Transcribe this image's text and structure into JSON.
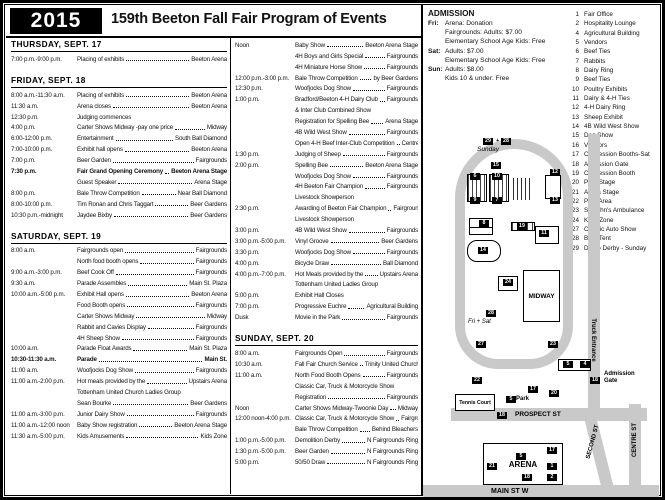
{
  "header": {
    "year": "2015",
    "title": "159th Beeton Fall Fair Program of Events"
  },
  "admission": {
    "title": "ADMISSION",
    "rows": [
      {
        "day": "Fri:",
        "text": "Arena: Donation"
      },
      {
        "day": "",
        "text": "Fairgrounds: Adults: $7.00"
      },
      {
        "day": "",
        "text": "Elementary School Age Kids: Free"
      },
      {
        "day": "Sat:",
        "text": "Adults: $7.00"
      },
      {
        "day": "",
        "text": "Elementary School Age Kids: Free"
      },
      {
        "day": "Sun:",
        "text": "Adults: $8.00"
      },
      {
        "day": "",
        "text": "Kids 10 & under: Free"
      }
    ]
  },
  "legend": {
    "items": [
      {
        "num": "1",
        "label": "Fair Office"
      },
      {
        "num": "2",
        "label": "Hospitality Lounge"
      },
      {
        "num": "4",
        "label": "Agricultural Building"
      },
      {
        "num": "5",
        "label": "Vendors"
      },
      {
        "num": "6",
        "label": "Beef Ties"
      },
      {
        "num": "7",
        "label": "Rabbits"
      },
      {
        "num": "8",
        "label": "Dairy Ring"
      },
      {
        "num": "9",
        "label": "Beef Ties"
      },
      {
        "num": "10",
        "label": "Poultry Exhibits"
      },
      {
        "num": "11",
        "label": "Dairy & 4-H Ties"
      },
      {
        "num": "12",
        "label": "4-H Dairy Ring"
      },
      {
        "num": "13",
        "label": "Sheep Exhibit"
      },
      {
        "num": "14",
        "label": "4B Wild West Show"
      },
      {
        "num": "15",
        "label": "Dog Show"
      },
      {
        "num": "16",
        "label": "Vendors"
      },
      {
        "num": "17",
        "label": "Concession Booths-Sat"
      },
      {
        "num": "18",
        "label": "Admission Gate"
      },
      {
        "num": "19",
        "label": "Concession Booth"
      },
      {
        "num": "20",
        "label": "Park Stage"
      },
      {
        "num": "21",
        "label": "Arena Stage"
      },
      {
        "num": "22",
        "label": "Park Area"
      },
      {
        "num": "23",
        "label": "St. John's Ambulance"
      },
      {
        "num": "24",
        "label": "Kid's Zone"
      },
      {
        "num": "27",
        "label": "Classic Auto Show"
      },
      {
        "num": "28",
        "label": "Beer Tent"
      },
      {
        "num": "29",
        "label": "Demo Derby - Sunday"
      }
    ]
  },
  "schedule": {
    "columns": [
      {
        "sections": [
          {
            "title": "THURSDAY, SEPT. 17",
            "rows": [
              {
                "t": "7:00 p.m.-9:00 p.m.",
                "e": "Placing of exhibits",
                "l": "Beeton Arena"
              }
            ]
          },
          {
            "title": "FRIDAY, SEPT. 18",
            "rows": [
              {
                "t": "8:00 a.m.-11:30 a.m.",
                "e": "Placing of exhibits",
                "l": "Beeton Arena"
              },
              {
                "t": "11:30 a.m.",
                "e": "Arena closes",
                "l": "Beeton Arena"
              },
              {
                "t": "12:30 p.m.",
                "e": "Judging commences",
                "l": ""
              },
              {
                "t": "4:00 p.m.",
                "e": "Carter Shows Midway -pay one price",
                "l": "Midway"
              },
              {
                "t": "6:00-12:00 p.m.",
                "e": "Entertainment",
                "l": "South Ball Diamond"
              },
              {
                "t": "7:00-10:00 p.m.",
                "e": "Exhibit hall opens",
                "l": "Beeton Arena"
              },
              {
                "t": "7:00 p.m.",
                "e": "Beer Garden",
                "l": "Fairgrounds"
              },
              {
                "t": "7:30 p.m.",
                "e": "Fair Grand Opening Ceremony",
                "l": "Beeton Arena Stage",
                "b": true
              },
              {
                "t": "",
                "e": "Guest Speaker",
                "l": "Arena Stage"
              },
              {
                "t": "8:00 p.m.",
                "e": "Bale Throw Competition",
                "l": "Near Ball Diamond"
              },
              {
                "t": "8:00-10:00 p.m.",
                "e": "Tim Ronan and Chris Taggart",
                "l": "Beer Gardens"
              },
              {
                "t": "10:30 p.m.-midnight",
                "e": "Jaydee Bixby",
                "l": "Beer Gardens"
              }
            ]
          },
          {
            "title": "SATURDAY, SEPT. 19",
            "rows": [
              {
                "t": "8:00 a.m.",
                "e": "Fairgrounds open",
                "l": "Fairgrounds"
              },
              {
                "t": "",
                "e": "North food booth opens",
                "l": "Fairgrounds"
              },
              {
                "t": "9:00 a.m.-3:00 p.m.",
                "e": "Beef Cook Off",
                "l": "Fairgrounds"
              },
              {
                "t": "9:30 a.m.",
                "e": "Parade Assembles",
                "l": "Main St. Plaza"
              },
              {
                "t": "10:00 a.m.-5:00 p.m.",
                "e": "Exhibit Hall opens",
                "l": "Beeton Arena"
              },
              {
                "t": "",
                "e": "Food Booth opens",
                "l": "Fairgrounds"
              },
              {
                "t": "",
                "e": "Carter Shows Midway",
                "l": "Midway"
              },
              {
                "t": "",
                "e": "Rabbit and Cavies Display",
                "l": "Fairgrounds"
              },
              {
                "t": "",
                "e": "4H Sheep Show",
                "l": "Fairgrounds"
              },
              {
                "t": "10:00 a.m.",
                "e": "Parade Float Awards",
                "l": "Main St. Plaza"
              },
              {
                "t": "10:30-11:30 a.m.",
                "e": "Parade",
                "l": "Main St.",
                "b": true
              },
              {
                "t": "11:00 a.m.",
                "e": "Woofjocks Dog Show",
                "l": "Fairgrounds"
              },
              {
                "t": "11:00 a.m.-2:00 p.m.",
                "e": "Hot meals provided by the",
                "l": "Upstairs Arena"
              },
              {
                "t": "",
                "e": "Tottenham United Church Ladies Group",
                "l": "",
                "s": true
              },
              {
                "t": "",
                "e": "Sean Bourke",
                "l": "Beer Gardens"
              },
              {
                "t": "11:00 a.m.-3:00 p.m.",
                "e": "Junior Dairy Show",
                "l": "Fairgrounds"
              },
              {
                "t": "11:00 a.m.-12:00 noon",
                "e": "Baby Show registration",
                "l": "Beeton Arena Stage"
              },
              {
                "t": "11:30 a.m.-5:00 p.m.",
                "e": "Kids Amusements",
                "l": "Kids Zone"
              }
            ]
          }
        ]
      },
      {
        "sections": [
          {
            "title": "",
            "rows": [
              {
                "t": "Noon",
                "e": "Baby Show",
                "l": "Beeton Arena Stage"
              },
              {
                "t": "",
                "e": "4H Boys and Girls Special",
                "l": "Fairgrounds"
              },
              {
                "t": "",
                "e": "4H Miniature Horse Show",
                "l": "Fairgrounds"
              },
              {
                "t": "12:00 p.m.-3:00 p.m.",
                "e": "Bale Throw Competition",
                "l": "by Beer Gardens"
              },
              {
                "t": "12:30 p.m.",
                "e": "Woofjocks Dog Show",
                "l": "Fairgrounds"
              },
              {
                "t": "1:00 p.m.",
                "e": "Bradford/Beeton 4-H Dairy Club",
                "l": "Fairgrounds"
              },
              {
                "t": "",
                "e": "& Inter Club Combined Show",
                "l": "",
                "s": true
              },
              {
                "t": "",
                "e": "Registration for Spelling Bee",
                "l": "Arena Stage"
              },
              {
                "t": "",
                "e": "4B Wild West Show",
                "l": "Fairgrounds"
              },
              {
                "t": "",
                "e": "Open 4-H Beef Inter-Club Competition",
                "l": "Centre Fairgrounds"
              },
              {
                "t": "1:30 p.m.",
                "e": "Judging of Sheep",
                "l": "Fairgrounds"
              },
              {
                "t": "2:00 p.m.",
                "e": "Spelling Bee",
                "l": "Beeton Arena Stage"
              },
              {
                "t": "",
                "e": "Woofjocks Dog Show",
                "l": "Fairgrounds"
              },
              {
                "t": "",
                "e": "4H Beeton Fair Champion",
                "l": "Fairgrounds"
              },
              {
                "t": "",
                "e": "Livestock Showperson",
                "l": "",
                "s": true
              },
              {
                "t": "2:30 p.m.",
                "e": "Awarding of Beeton Fair Champion",
                "l": "Fairgrounds"
              },
              {
                "t": "",
                "e": "Livestock Showperson",
                "l": "",
                "s": true
              },
              {
                "t": "3:00 p.m.",
                "e": "4B Wild West Show",
                "l": "Fairgrounds"
              },
              {
                "t": "3:00 p.m.-5:00 p.m.",
                "e": "Vinyl Groove",
                "l": "Beer Gardens"
              },
              {
                "t": "3:30 p.m.",
                "e": "Woofjocks Dog Show",
                "l": "Fairgrounds"
              },
              {
                "t": "4:00 p.m.",
                "e": "Bicycle Draw",
                "l": "Ball Diamond"
              },
              {
                "t": "4:00 p.m.-7:00 p.m.",
                "e": "Hot Meals provided by the",
                "l": "Upstairs Arena"
              },
              {
                "t": "",
                "e": "Tottenham United Ladies Group",
                "l": "",
                "s": true
              },
              {
                "t": "5:00 p.m.",
                "e": "Exhibit Hall Closes",
                "l": ""
              },
              {
                "t": "7:00 p.m.",
                "e": "Progressive Euchre",
                "l": "Agricultural Building"
              },
              {
                "t": "Dusk",
                "e": "Movie in the Park",
                "l": "Fairgrounds"
              }
            ]
          },
          {
            "title": "SUNDAY, SEPT. 20",
            "rows": [
              {
                "t": "8:00 a.m.",
                "e": "Fairgrounds Open",
                "l": "Fairgrounds"
              },
              {
                "t": "10:30 a.m.",
                "e": "Fall Fair Church Service",
                "l": "Trinity United Church"
              },
              {
                "t": "11:00 a.m.",
                "e": "North Food Booth Opens",
                "l": "Fairgrounds"
              },
              {
                "t": "",
                "e": "Classic Car, Truck & Motorcycle Show",
                "l": ""
              },
              {
                "t": "",
                "e": "Registration",
                "l": "Fairgrounds"
              },
              {
                "t": "Noon",
                "e": "Carter Shows Midway-Twoonie Day",
                "l": "Midway"
              },
              {
                "t": "12:00 noon-4:00 p.m.",
                "e": "Classic Car, Truck & Motorcycle Show",
                "l": "Fairgrounds"
              },
              {
                "t": "",
                "e": "Bale Throw Competition",
                "l": "Behind Bleachers"
              },
              {
                "t": "1:00 p.m.-5:00 p.m.",
                "e": "Demolition Derby",
                "l": "N Fairgrounds Ring"
              },
              {
                "t": "1:30 p.m.-5:00 p.m.",
                "e": "Beer Garden",
                "l": "N Fairgrounds Ring"
              },
              {
                "t": "5:00 p.m.",
                "e": "50/50 Draw",
                "l": "N Fairgrounds Ring"
              }
            ]
          }
        ]
      }
    ]
  },
  "map": {
    "labels": {
      "sunday": "Sunday",
      "fri_sat": "Fri + Sat",
      "plus": "+",
      "midway": "MIDWAY",
      "arena": "ARENA",
      "tennis": "Tennis Court",
      "park": "Park",
      "admission_gate": "Admission Gate",
      "prospect": "PROSPECT ST",
      "main": "MAIN ST W",
      "second": "SECOND ST",
      "centre": "CENTRE ST",
      "truck": "Truck Entrance"
    },
    "markers": [
      {
        "n": "29",
        "x": 60,
        "y": 131
      },
      {
        "n": "28",
        "x": 78,
        "y": 131
      },
      {
        "n": "15",
        "x": 68,
        "y": 155
      },
      {
        "n": "6",
        "x": 47,
        "y": 166
      },
      {
        "n": "10",
        "x": 69,
        "y": 166
      },
      {
        "n": "9",
        "x": 47,
        "y": 190
      },
      {
        "n": "7",
        "x": 69,
        "y": 190
      },
      {
        "n": "12",
        "x": 127,
        "y": 162
      },
      {
        "n": "13",
        "x": 127,
        "y": 190
      },
      {
        "n": "8",
        "x": 56,
        "y": 213
      },
      {
        "n": "19",
        "x": 94,
        "y": 216
      },
      {
        "n": "11",
        "x": 116,
        "y": 223
      },
      {
        "n": "14",
        "x": 55,
        "y": 240
      },
      {
        "n": "24",
        "x": 80,
        "y": 272
      },
      {
        "n": "28",
        "x": 63,
        "y": 303
      },
      {
        "n": "27",
        "x": 53,
        "y": 334
      },
      {
        "n": "23",
        "x": 125,
        "y": 334
      },
      {
        "n": "5",
        "x": 140,
        "y": 354
      },
      {
        "n": "4",
        "x": 157,
        "y": 354
      },
      {
        "n": "18",
        "x": 167,
        "y": 370
      },
      {
        "n": "22",
        "x": 49,
        "y": 370
      },
      {
        "n": "17",
        "x": 105,
        "y": 379
      },
      {
        "n": "20",
        "x": 126,
        "y": 383
      },
      {
        "n": "5",
        "x": 83,
        "y": 389
      },
      {
        "n": "18",
        "x": 74,
        "y": 405
      },
      {
        "n": "17",
        "x": 124,
        "y": 440
      },
      {
        "n": "5",
        "x": 93,
        "y": 446
      },
      {
        "n": "21",
        "x": 64,
        "y": 456
      },
      {
        "n": "1",
        "x": 124,
        "y": 456
      },
      {
        "n": "18",
        "x": 99,
        "y": 467
      },
      {
        "n": "2",
        "x": 124,
        "y": 467
      }
    ]
  }
}
